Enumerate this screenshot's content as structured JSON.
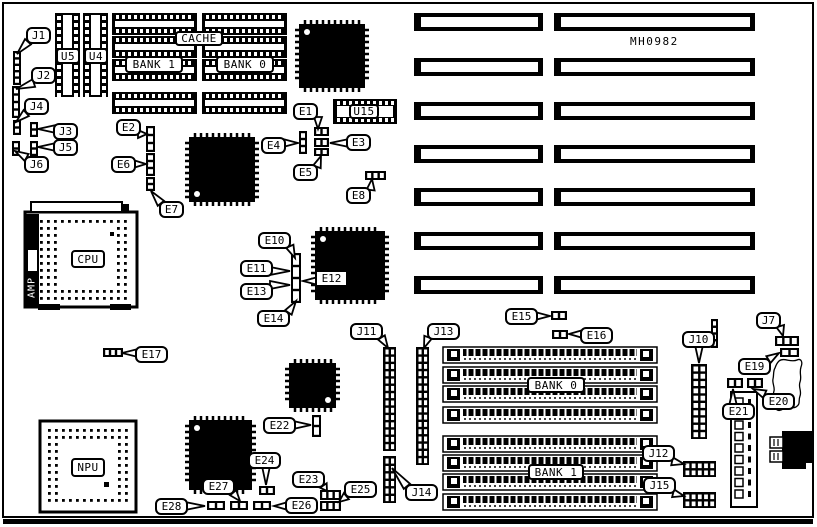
{
  "diagram": {
    "board_code": "MH0982",
    "ink": "#000000",
    "bg": "#ffffff"
  },
  "amp": {
    "label": "AMP"
  },
  "part_labels": [
    {
      "id": "cache-label",
      "label": "CACHE",
      "x": 175,
      "y": 31,
      "w": 48,
      "h": 15
    },
    {
      "id": "cache-bank-1-label",
      "label": "BANK 1",
      "x": 125,
      "y": 56,
      "w": 58,
      "h": 17
    },
    {
      "id": "cache-bank-0-label",
      "label": "BANK 0",
      "x": 216,
      "y": 56,
      "w": 58,
      "h": 17
    },
    {
      "id": "u5-label",
      "label": "U5",
      "x": 56,
      "y": 48,
      "w": 24,
      "h": 16
    },
    {
      "id": "u4-label",
      "label": "U4",
      "x": 84,
      "y": 48,
      "w": 24,
      "h": 16
    },
    {
      "id": "u15-label",
      "label": "U15",
      "x": 349,
      "y": 104,
      "w": 30,
      "h": 15
    },
    {
      "id": "cpu-label",
      "label": "CPU",
      "x": 71,
      "y": 250,
      "w": 34,
      "h": 18
    },
    {
      "id": "npu-label",
      "label": "NPU",
      "x": 71,
      "y": 458,
      "w": 34,
      "h": 19
    },
    {
      "id": "ram-bank-0-label",
      "label": "BANK 0",
      "x": 527,
      "y": 377,
      "w": 58,
      "h": 16
    },
    {
      "id": "ram-bank-1-label",
      "label": "BANK 1",
      "x": 528,
      "y": 464,
      "w": 56,
      "h": 16
    }
  ],
  "callouts": [
    {
      "label": "J1",
      "x": 26,
      "y": 27,
      "tx": 17,
      "ty": 54
    },
    {
      "label": "J2",
      "x": 31,
      "y": 67,
      "tx": 16,
      "ty": 89
    },
    {
      "label": "J4",
      "x": 24,
      "y": 98,
      "tx": 16,
      "ty": 122
    },
    {
      "label": "J3",
      "x": 53,
      "y": 123,
      "tx": 38,
      "ty": 129
    },
    {
      "label": "J5",
      "x": 53,
      "y": 139,
      "tx": 38,
      "ty": 147
    },
    {
      "label": "J6",
      "x": 24,
      "y": 156,
      "tx": 15,
      "ty": 151
    },
    {
      "label": "E2",
      "x": 116,
      "y": 119,
      "tx": 147,
      "ty": 134
    },
    {
      "label": "E6",
      "x": 111,
      "y": 156,
      "tx": 146,
      "ty": 164
    },
    {
      "label": "E7",
      "x": 159,
      "y": 201,
      "tx": 151,
      "ty": 191
    },
    {
      "label": "E1",
      "x": 293,
      "y": 103,
      "tx": 318,
      "ty": 129
    },
    {
      "label": "E4",
      "x": 261,
      "y": 137,
      "tx": 298,
      "ty": 143
    },
    {
      "label": "E3",
      "x": 346,
      "y": 134,
      "tx": 330,
      "ty": 143
    },
    {
      "label": "E5",
      "x": 293,
      "y": 164,
      "tx": 321,
      "ty": 156
    },
    {
      "label": "E8",
      "x": 346,
      "y": 187,
      "tx": 372,
      "ty": 179
    },
    {
      "label": "E10",
      "x": 258,
      "y": 232,
      "tx": 295,
      "ty": 258
    },
    {
      "label": "E11",
      "x": 240,
      "y": 260,
      "tx": 290,
      "ty": 271
    },
    {
      "label": "E13",
      "x": 240,
      "y": 283,
      "tx": 290,
      "ty": 285
    },
    {
      "label": "E14",
      "x": 257,
      "y": 310,
      "tx": 296,
      "ty": 301
    },
    {
      "label": "E12",
      "x": 315,
      "y": 270,
      "tx": 303,
      "ty": 281,
      "sq": true
    },
    {
      "label": "E17",
      "x": 135,
      "y": 346,
      "tx": 122,
      "ty": 353
    },
    {
      "label": "J11",
      "x": 350,
      "y": 323,
      "tx": 388,
      "ty": 348
    },
    {
      "label": "J13",
      "x": 427,
      "y": 323,
      "tx": 424,
      "ty": 348
    },
    {
      "label": "E15",
      "x": 505,
      "y": 308,
      "tx": 550,
      "ty": 316
    },
    {
      "label": "E16",
      "x": 580,
      "y": 327,
      "tx": 569,
      "ty": 334
    },
    {
      "label": "J7",
      "x": 756,
      "y": 312,
      "tx": 783,
      "ty": 336
    },
    {
      "label": "E19",
      "x": 738,
      "y": 358,
      "tx": 779,
      "ty": 353
    },
    {
      "label": "E21",
      "x": 722,
      "y": 403,
      "tx": 733,
      "ty": 389
    },
    {
      "label": "E20",
      "x": 762,
      "y": 393,
      "tx": 753,
      "ty": 389
    },
    {
      "label": "J10",
      "x": 682,
      "y": 331,
      "tx": 699,
      "ty": 363
    },
    {
      "label": "J12",
      "x": 642,
      "y": 445,
      "tx": 684,
      "ty": 464
    },
    {
      "label": "J15",
      "x": 643,
      "y": 477,
      "tx": 684,
      "ty": 496
    },
    {
      "label": "J14",
      "x": 405,
      "y": 484,
      "tx": 392,
      "ty": 468
    },
    {
      "label": "E22",
      "x": 263,
      "y": 417,
      "tx": 311,
      "ty": 425
    },
    {
      "label": "E24",
      "x": 248,
      "y": 452,
      "tx": 266,
      "ty": 485
    },
    {
      "label": "E23",
      "x": 292,
      "y": 471,
      "tx": 327,
      "ty": 491
    },
    {
      "label": "E26",
      "x": 285,
      "y": 497,
      "tx": 274,
      "ty": 506
    },
    {
      "label": "E25",
      "x": 344,
      "y": 481,
      "tx": 339,
      "ty": 502
    },
    {
      "label": "E27",
      "x": 202,
      "y": 478,
      "tx": 240,
      "ty": 501
    },
    {
      "label": "E28",
      "x": 155,
      "y": 498,
      "tx": 205,
      "ty": 506
    }
  ],
  "components": {
    "expansion_slots": {
      "rows_y": [
        13,
        58,
        102,
        145,
        188,
        232,
        276
      ],
      "h": 18,
      "left": {
        "x": 414,
        "w": 129
      },
      "right": {
        "x": 554,
        "w": 201
      }
    },
    "simm_sockets": {
      "rows_y": [
        347,
        367,
        386,
        407,
        436,
        455,
        474,
        494
      ],
      "x": 443,
      "w": 214,
      "h": 16
    },
    "cache_chips": {
      "cols_x": [
        112,
        202
      ],
      "rows_y": [
        13,
        36,
        59,
        92
      ],
      "w": 85,
      "h": 22
    },
    "dip_sockets_v": [
      {
        "id": "u5-socket",
        "x": 55,
        "y": 13,
        "w": 25,
        "h": 84
      },
      {
        "id": "u4-socket",
        "x": 83,
        "y": 13,
        "w": 25,
        "h": 84
      }
    ],
    "dip_sockets_h": [
      {
        "id": "u15-socket",
        "x": 333,
        "y": 99,
        "w": 64,
        "h": 25
      }
    ],
    "qfp_chips": [
      {
        "id": "qfp-chip-a",
        "x": 299,
        "y": 24,
        "w": 66,
        "h": 64,
        "dot": "tl"
      },
      {
        "id": "qfp-chip-b",
        "x": 189,
        "y": 137,
        "w": 66,
        "h": 65,
        "dot": "bl"
      },
      {
        "id": "qfp-chip-c",
        "x": 315,
        "y": 231,
        "w": 70,
        "h": 69,
        "dot": "tl"
      },
      {
        "id": "qfp-chip-d",
        "x": 189,
        "y": 420,
        "w": 63,
        "h": 70,
        "dot": "tl"
      },
      {
        "id": "qfp-chip-e",
        "x": 289,
        "y": 363,
        "w": 47,
        "h": 45,
        "dot": "br"
      }
    ],
    "pga_sockets": [
      {
        "id": "cpu-socket",
        "x": 25,
        "y": 212,
        "w": 112,
        "h": 95,
        "cx": 57,
        "cy": 227,
        "cw": 53,
        "ch": 60
      },
      {
        "id": "npu-socket",
        "x": 40,
        "y": 421,
        "w": 96,
        "h": 91,
        "cx": 63,
        "cy": 443,
        "cw": 50,
        "ch": 47
      }
    ],
    "pin_headers": [
      {
        "id": "j11-header",
        "x": 383,
        "y": 347,
        "w": 13,
        "h": 104,
        "cols": 2,
        "rows": 14
      },
      {
        "id": "j13-header",
        "x": 416,
        "y": 347,
        "w": 13,
        "h": 118,
        "cols": 2,
        "rows": 16
      },
      {
        "id": "j14-header",
        "x": 383,
        "y": 456,
        "w": 13,
        "h": 47,
        "cols": 2,
        "rows": 6
      },
      {
        "id": "j10-header",
        "x": 691,
        "y": 364,
        "w": 16,
        "h": 75,
        "cols": 2,
        "rows": 10
      },
      {
        "id": "j12-header",
        "x": 683,
        "y": 461,
        "w": 33,
        "h": 16,
        "cols": 5,
        "rows": 2
      },
      {
        "id": "j15-header",
        "x": 683,
        "y": 492,
        "w": 33,
        "h": 16,
        "cols": 5,
        "rows": 2
      }
    ],
    "jumpers": [
      {
        "id": "j1-jumper",
        "x": 13,
        "y": 51,
        "w": 8,
        "h": 34,
        "o": "v",
        "pads": 5
      },
      {
        "id": "j2-jumper",
        "x": 12,
        "y": 86,
        "w": 8,
        "h": 32,
        "o": "v",
        "pads": 4
      },
      {
        "id": "j4-jumper",
        "x": 13,
        "y": 120,
        "w": 8,
        "h": 15,
        "o": "v",
        "pads": 2
      },
      {
        "id": "j3-jumper",
        "x": 30,
        "y": 122,
        "w": 8,
        "h": 15,
        "o": "v",
        "pads": 2
      },
      {
        "id": "j5-jumper",
        "x": 30,
        "y": 141,
        "w": 8,
        "h": 15,
        "o": "v",
        "pads": 2
      },
      {
        "id": "j6-jumper",
        "x": 12,
        "y": 141,
        "w": 8,
        "h": 15,
        "o": "v",
        "pads": 2
      },
      {
        "id": "e2-jumper",
        "x": 146,
        "y": 126,
        "w": 9,
        "h": 26,
        "o": "v",
        "pads": 3
      },
      {
        "id": "e6-jumper",
        "x": 146,
        "y": 153,
        "w": 9,
        "h": 23,
        "o": "v",
        "pads": 3
      },
      {
        "id": "e7-jumper",
        "x": 146,
        "y": 177,
        "w": 9,
        "h": 14,
        "o": "v",
        "pads": 2
      },
      {
        "id": "e4-jumper",
        "x": 299,
        "y": 131,
        "w": 8,
        "h": 23,
        "o": "v",
        "pads": 3
      },
      {
        "id": "e1-jumper",
        "x": 314,
        "y": 127,
        "w": 15,
        "h": 9,
        "o": "h",
        "pads": 2
      },
      {
        "id": "e3-jumper",
        "x": 314,
        "y": 138,
        "w": 15,
        "h": 9,
        "o": "h",
        "pads": 2
      },
      {
        "id": "e5-jumper",
        "x": 314,
        "y": 148,
        "w": 15,
        "h": 8,
        "o": "h",
        "pads": 2
      },
      {
        "id": "e8-jumper",
        "x": 365,
        "y": 171,
        "w": 21,
        "h": 9,
        "o": "h",
        "pads": 3
      },
      {
        "id": "e17-jumper",
        "x": 103,
        "y": 348,
        "w": 20,
        "h": 9,
        "o": "h",
        "pads": 3
      },
      {
        "id": "e10-e14-jumper",
        "x": 291,
        "y": 253,
        "w": 10,
        "h": 50,
        "o": "v",
        "pads": 4
      },
      {
        "id": "e15-jumper",
        "x": 551,
        "y": 311,
        "w": 16,
        "h": 9,
        "o": "h",
        "pads": 2
      },
      {
        "id": "e16-jumper",
        "x": 552,
        "y": 330,
        "w": 16,
        "h": 9,
        "o": "h",
        "pads": 2
      },
      {
        "id": "j7-jumper",
        "x": 775,
        "y": 336,
        "w": 24,
        "h": 10,
        "o": "h",
        "pads": 3
      },
      {
        "id": "e19-jumper",
        "x": 780,
        "y": 348,
        "w": 19,
        "h": 9,
        "o": "h",
        "pads": 2
      },
      {
        "id": "e21-jumper",
        "x": 727,
        "y": 378,
        "w": 16,
        "h": 10,
        "o": "h",
        "pads": 2
      },
      {
        "id": "e20-jumper",
        "x": 747,
        "y": 378,
        "w": 16,
        "h": 10,
        "o": "h",
        "pads": 2
      },
      {
        "id": "aux-header",
        "x": 711,
        "y": 319,
        "w": 7,
        "h": 29,
        "o": "v",
        "pads": 4
      },
      {
        "id": "e22-jumper",
        "x": 312,
        "y": 415,
        "w": 9,
        "h": 22,
        "o": "v",
        "pads": 2
      },
      {
        "id": "e24-jumper",
        "x": 259,
        "y": 486,
        "w": 16,
        "h": 9,
        "o": "h",
        "pads": 2
      },
      {
        "id": "e23-jumper",
        "x": 320,
        "y": 490,
        "w": 21,
        "h": 10,
        "o": "h",
        "pads": 3
      },
      {
        "id": "e25-jumper",
        "x": 320,
        "y": 501,
        "w": 21,
        "h": 10,
        "o": "h",
        "pads": 3
      },
      {
        "id": "e26-jumper",
        "x": 253,
        "y": 501,
        "w": 18,
        "h": 9,
        "o": "h",
        "pads": 2
      },
      {
        "id": "e27-jumper",
        "x": 230,
        "y": 501,
        "w": 18,
        "h": 9,
        "o": "h",
        "pads": 2
      },
      {
        "id": "e28-jumper",
        "x": 207,
        "y": 501,
        "w": 18,
        "h": 9,
        "o": "h",
        "pads": 2
      }
    ],
    "power_connector": {
      "id": "power-connector",
      "x": 731,
      "y": 392,
      "w": 26,
      "h": 115,
      "pins": 9
    },
    "keyboard_connector": {
      "id": "keyboard-connector",
      "x": 782,
      "y": 431
    },
    "cpu_extras": {
      "bar": [
        31,
        202,
        91,
        10
      ],
      "bar_nub": [
        123,
        204,
        6,
        7
      ],
      "feet": [
        [
          38,
          304,
          22,
          6
        ],
        [
          110,
          304,
          21,
          6
        ]
      ],
      "amp_bar": [
        26,
        214,
        13,
        92
      ],
      "amp_window": [
        28,
        250,
        9,
        21
      ],
      "pin1": [
        110,
        232,
        4,
        4
      ]
    },
    "npu_extras": {
      "pin1": [
        104,
        482,
        5,
        5
      ]
    }
  }
}
